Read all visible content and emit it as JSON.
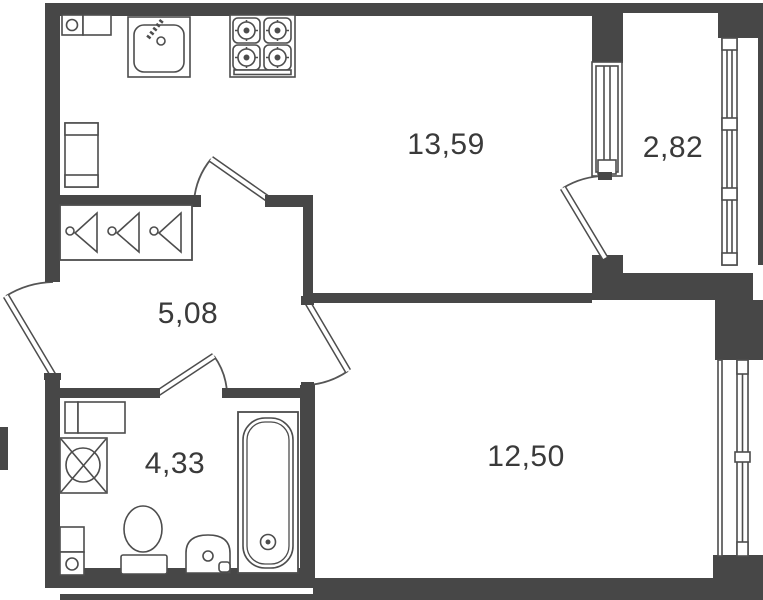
{
  "title": "one-room-apartment-floor-plan",
  "rooms": {
    "kitchen": {
      "area": "13,59"
    },
    "balcony": {
      "area": "2,82"
    },
    "hallway": {
      "area": "5,08"
    },
    "bathroom": {
      "area": "4,33"
    },
    "room": {
      "area": "12,50"
    }
  },
  "fixtures": [
    "kitchen-counter",
    "kitchen-sink",
    "stove-4-burner",
    "fridge-cabinet",
    "wardrobe-with-hangers",
    "entry-door",
    "kitchen-door",
    "bathroom-door",
    "room-door",
    "balcony-door",
    "balcony-window",
    "room-window",
    "bathroom-cabinet",
    "washing-machine",
    "water-heater",
    "toilet",
    "washbasin",
    "bathtub"
  ],
  "colors": {
    "wall": "#474747",
    "line": "#4d4d4d",
    "text": "#3a3a3a",
    "background": "#ffffff"
  }
}
